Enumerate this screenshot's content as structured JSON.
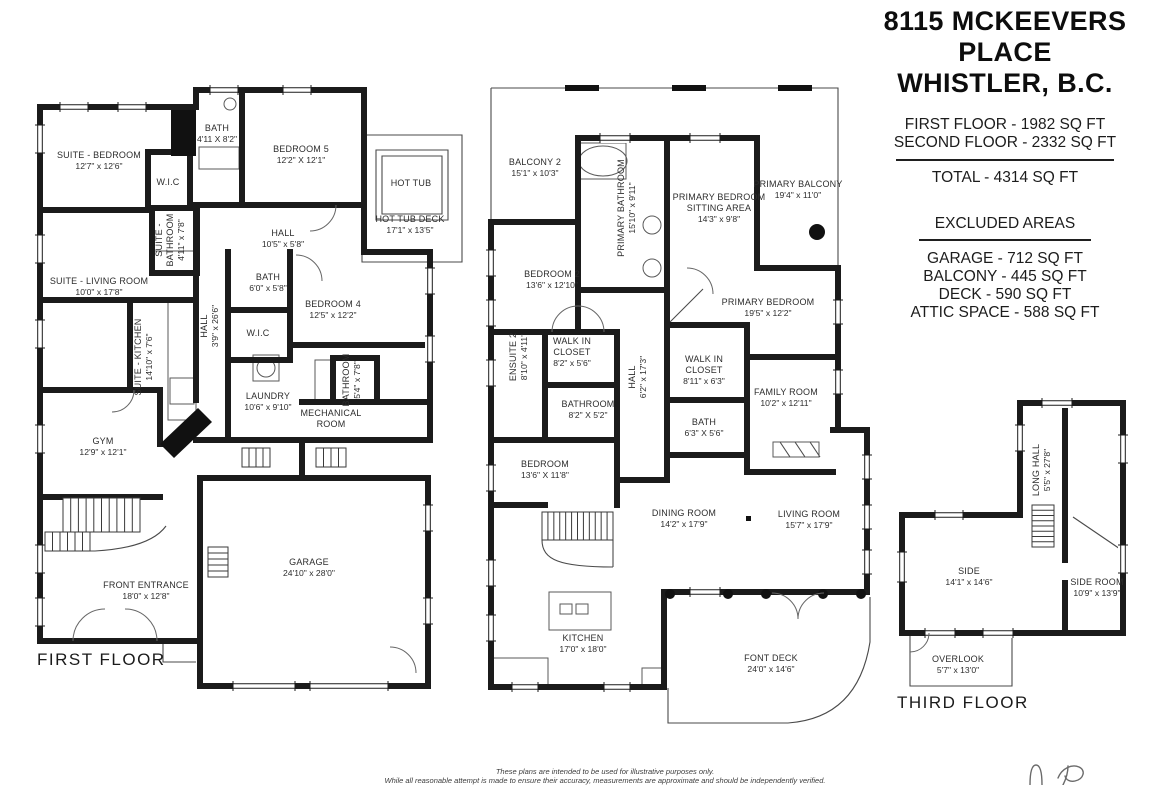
{
  "header": {
    "title_line1": "8115 MCKEEVERS PLACE",
    "title_line2": "WHISTLER, B.C.",
    "area_lines": [
      "FIRST FLOOR - 1982 SQ FT",
      "SECOND FLOOR - 2332 SQ FT"
    ],
    "total_line": "TOTAL - 4314 SQ FT",
    "excluded_title": "EXCLUDED AREAS",
    "excluded_lines": [
      "GARAGE - 712 SQ FT",
      "BALCONY - 445 SQ FT",
      "DECK - 590 SQ FT",
      "ATTIC SPACE - 588 SQ FT"
    ]
  },
  "colors": {
    "wall": "#1b1b1b",
    "label_text": "#2d2d2d",
    "accent_dot": "#111111"
  },
  "floors": [
    {
      "name": "FIRST FLOOR",
      "label": {
        "text": "FIRST FLOOR",
        "x": 37,
        "y": 665
      },
      "rooms": [
        {
          "lines": [
            "SUITE - BEDROOM"
          ],
          "dims": "12'7\" x 12'6\"",
          "x": 99,
          "y": 158
        },
        {
          "lines": [
            "W.I.C"
          ],
          "x": 168,
          "y": 185
        },
        {
          "lines": [
            "BATH"
          ],
          "dims": "4'11 X 8'2\"",
          "x": 217,
          "y": 131
        },
        {
          "lines": [
            "BEDROOM 5"
          ],
          "dims": "12'2\" X 12'1\"",
          "x": 301,
          "y": 152
        },
        {
          "lines": [
            "SUITE -",
            "BATHROOM"
          ],
          "dims": "4'11\" x 7'8\"",
          "x": 162,
          "y": 240,
          "rot": -90
        },
        {
          "lines": [
            "HALL"
          ],
          "dims": "10'5\" x 5'8\"",
          "x": 283,
          "y": 236
        },
        {
          "lines": [
            "HOT TUB"
          ],
          "x": 411,
          "y": 186
        },
        {
          "lines": [
            "HOT TUB DECK"
          ],
          "dims": "17'1\" x 13'5\"",
          "x": 410,
          "y": 222
        },
        {
          "lines": [
            "SUITE - LIVING ROOM"
          ],
          "dims": "10'0\" x 17'8\"",
          "x": 99,
          "y": 284
        },
        {
          "lines": [
            "SUITE - KITCHEN"
          ],
          "dims": "14'10\" x 7'6\"",
          "x": 141,
          "y": 357,
          "rot": -90
        },
        {
          "lines": [
            "HALL"
          ],
          "dims": "3'9\" x 26'6\"",
          "x": 207,
          "y": 326,
          "rot": -90
        },
        {
          "lines": [
            "BATH"
          ],
          "dims": "6'0\" x 5'8\"",
          "x": 268,
          "y": 280
        },
        {
          "lines": [
            "BEDROOM 4"
          ],
          "dims": "12'5\" x 12'2\"",
          "x": 333,
          "y": 307
        },
        {
          "lines": [
            "W.I.C"
          ],
          "x": 258,
          "y": 336
        },
        {
          "lines": [
            "BATHROOM"
          ],
          "dims": "5'4\" x 7'8\"",
          "x": 349,
          "y": 380,
          "rot": -90
        },
        {
          "lines": [
            "LAUNDRY"
          ],
          "dims": "10'6\" x 9'10\"",
          "x": 268,
          "y": 399
        },
        {
          "lines": [
            "MECHANICAL",
            "ROOM"
          ],
          "x": 331,
          "y": 416
        },
        {
          "lines": [
            "GYM"
          ],
          "dims": "12'9\" x 12'1\"",
          "x": 103,
          "y": 444
        },
        {
          "lines": [
            "FRONT ENTRANCE"
          ],
          "dims": "18'0\" x 12'8\"",
          "x": 146,
          "y": 588
        },
        {
          "lines": [
            "GARAGE"
          ],
          "dims": "24'10\" x 28'0\"",
          "x": 309,
          "y": 565
        }
      ]
    },
    {
      "name": "SECOND FLOOR",
      "label": null,
      "rooms": [
        {
          "lines": [
            "BALCONY 2"
          ],
          "dims": "15'1\" x 10'3\"",
          "x": 535,
          "y": 165
        },
        {
          "lines": [
            "PRIMARY BATHROOM"
          ],
          "dims": "15'10\" x 9'11\"",
          "x": 624,
          "y": 208,
          "rot": -90
        },
        {
          "lines": [
            "PRIMARY BEDROOM",
            "SITTING AREA"
          ],
          "dims": "14'3\" x 9'8\"",
          "x": 719,
          "y": 200
        },
        {
          "lines": [
            "PRIMARY BALCONY"
          ],
          "dims": "19'4\" x 11'0\"",
          "x": 798,
          "y": 187
        },
        {
          "lines": [
            "BEDROOM 2"
          ],
          "dims": "13'6\" x 12'10\"",
          "x": 552,
          "y": 277
        },
        {
          "lines": [
            "PRIMARY BEDROOM"
          ],
          "dims": "19'5\" x 12'2\"",
          "x": 768,
          "y": 305
        },
        {
          "lines": [
            "ENSUITE 2"
          ],
          "dims": "8'10\" x 4'11\"",
          "x": 516,
          "y": 357,
          "rot": -90
        },
        {
          "lines": [
            "WALK IN",
            "CLOSET"
          ],
          "dims": "8'2\" x 5'6\"",
          "x": 572,
          "y": 344
        },
        {
          "lines": [
            "HALL"
          ],
          "dims": "6'2\" x 17'3\"",
          "x": 635,
          "y": 377,
          "rot": -90
        },
        {
          "lines": [
            "WALK IN",
            "CLOSET"
          ],
          "dims": "8'11\" x 6'3\"",
          "x": 704,
          "y": 362
        },
        {
          "lines": [
            "FAMILY ROOM"
          ],
          "dims": "10'2\" x 12'11\"",
          "x": 786,
          "y": 395
        },
        {
          "lines": [
            "BATHROOM"
          ],
          "dims": "8'2\" X 5'2\"",
          "x": 588,
          "y": 407
        },
        {
          "lines": [
            "BATH"
          ],
          "dims": "6'3\" X 5'6\"",
          "x": 704,
          "y": 425
        },
        {
          "lines": [
            "BEDROOM"
          ],
          "dims": "13'6\" X 11'8\"",
          "x": 545,
          "y": 467
        },
        {
          "lines": [
            "DINING ROOM"
          ],
          "dims": "14'2\" x 17'9\"",
          "x": 684,
          "y": 516
        },
        {
          "lines": [
            "LIVING ROOM"
          ],
          "dims": "15'7\" x 17'9\"",
          "x": 809,
          "y": 517
        },
        {
          "lines": [
            "KITCHEN"
          ],
          "dims": "17'0\" x 18'0\"",
          "x": 583,
          "y": 641
        },
        {
          "lines": [
            "FONT DECK"
          ],
          "dims": "24'0\" x 14'6\"",
          "x": 771,
          "y": 661
        }
      ]
    },
    {
      "name": "THIRD FLOOR",
      "label": {
        "text": "THIRD FLOOR",
        "x": 897,
        "y": 708
      },
      "rooms": [
        {
          "lines": [
            "LONG HALL"
          ],
          "dims": "5'5\" x 27'8\"",
          "x": 1039,
          "y": 470,
          "rot": -90
        },
        {
          "lines": [
            "SIDE"
          ],
          "dims": "14'1\" x 14'6\"",
          "x": 969,
          "y": 574
        },
        {
          "lines": [
            "SIDE ROOM"
          ],
          "dims": "10'9\" x 13'9\"",
          "x": 1097,
          "y": 585
        },
        {
          "lines": [
            "OVERLOOK"
          ],
          "dims": "5'7\" x 13'0\"",
          "x": 958,
          "y": 662
        }
      ]
    }
  ],
  "footer": {
    "disclaimer_line1": "These plans are intended to be used for illustrative purposes only.",
    "disclaimer_line2": "While all reasonable attempt is made to ensure their accuracy, measurements are approximate and should be independently verified."
  }
}
